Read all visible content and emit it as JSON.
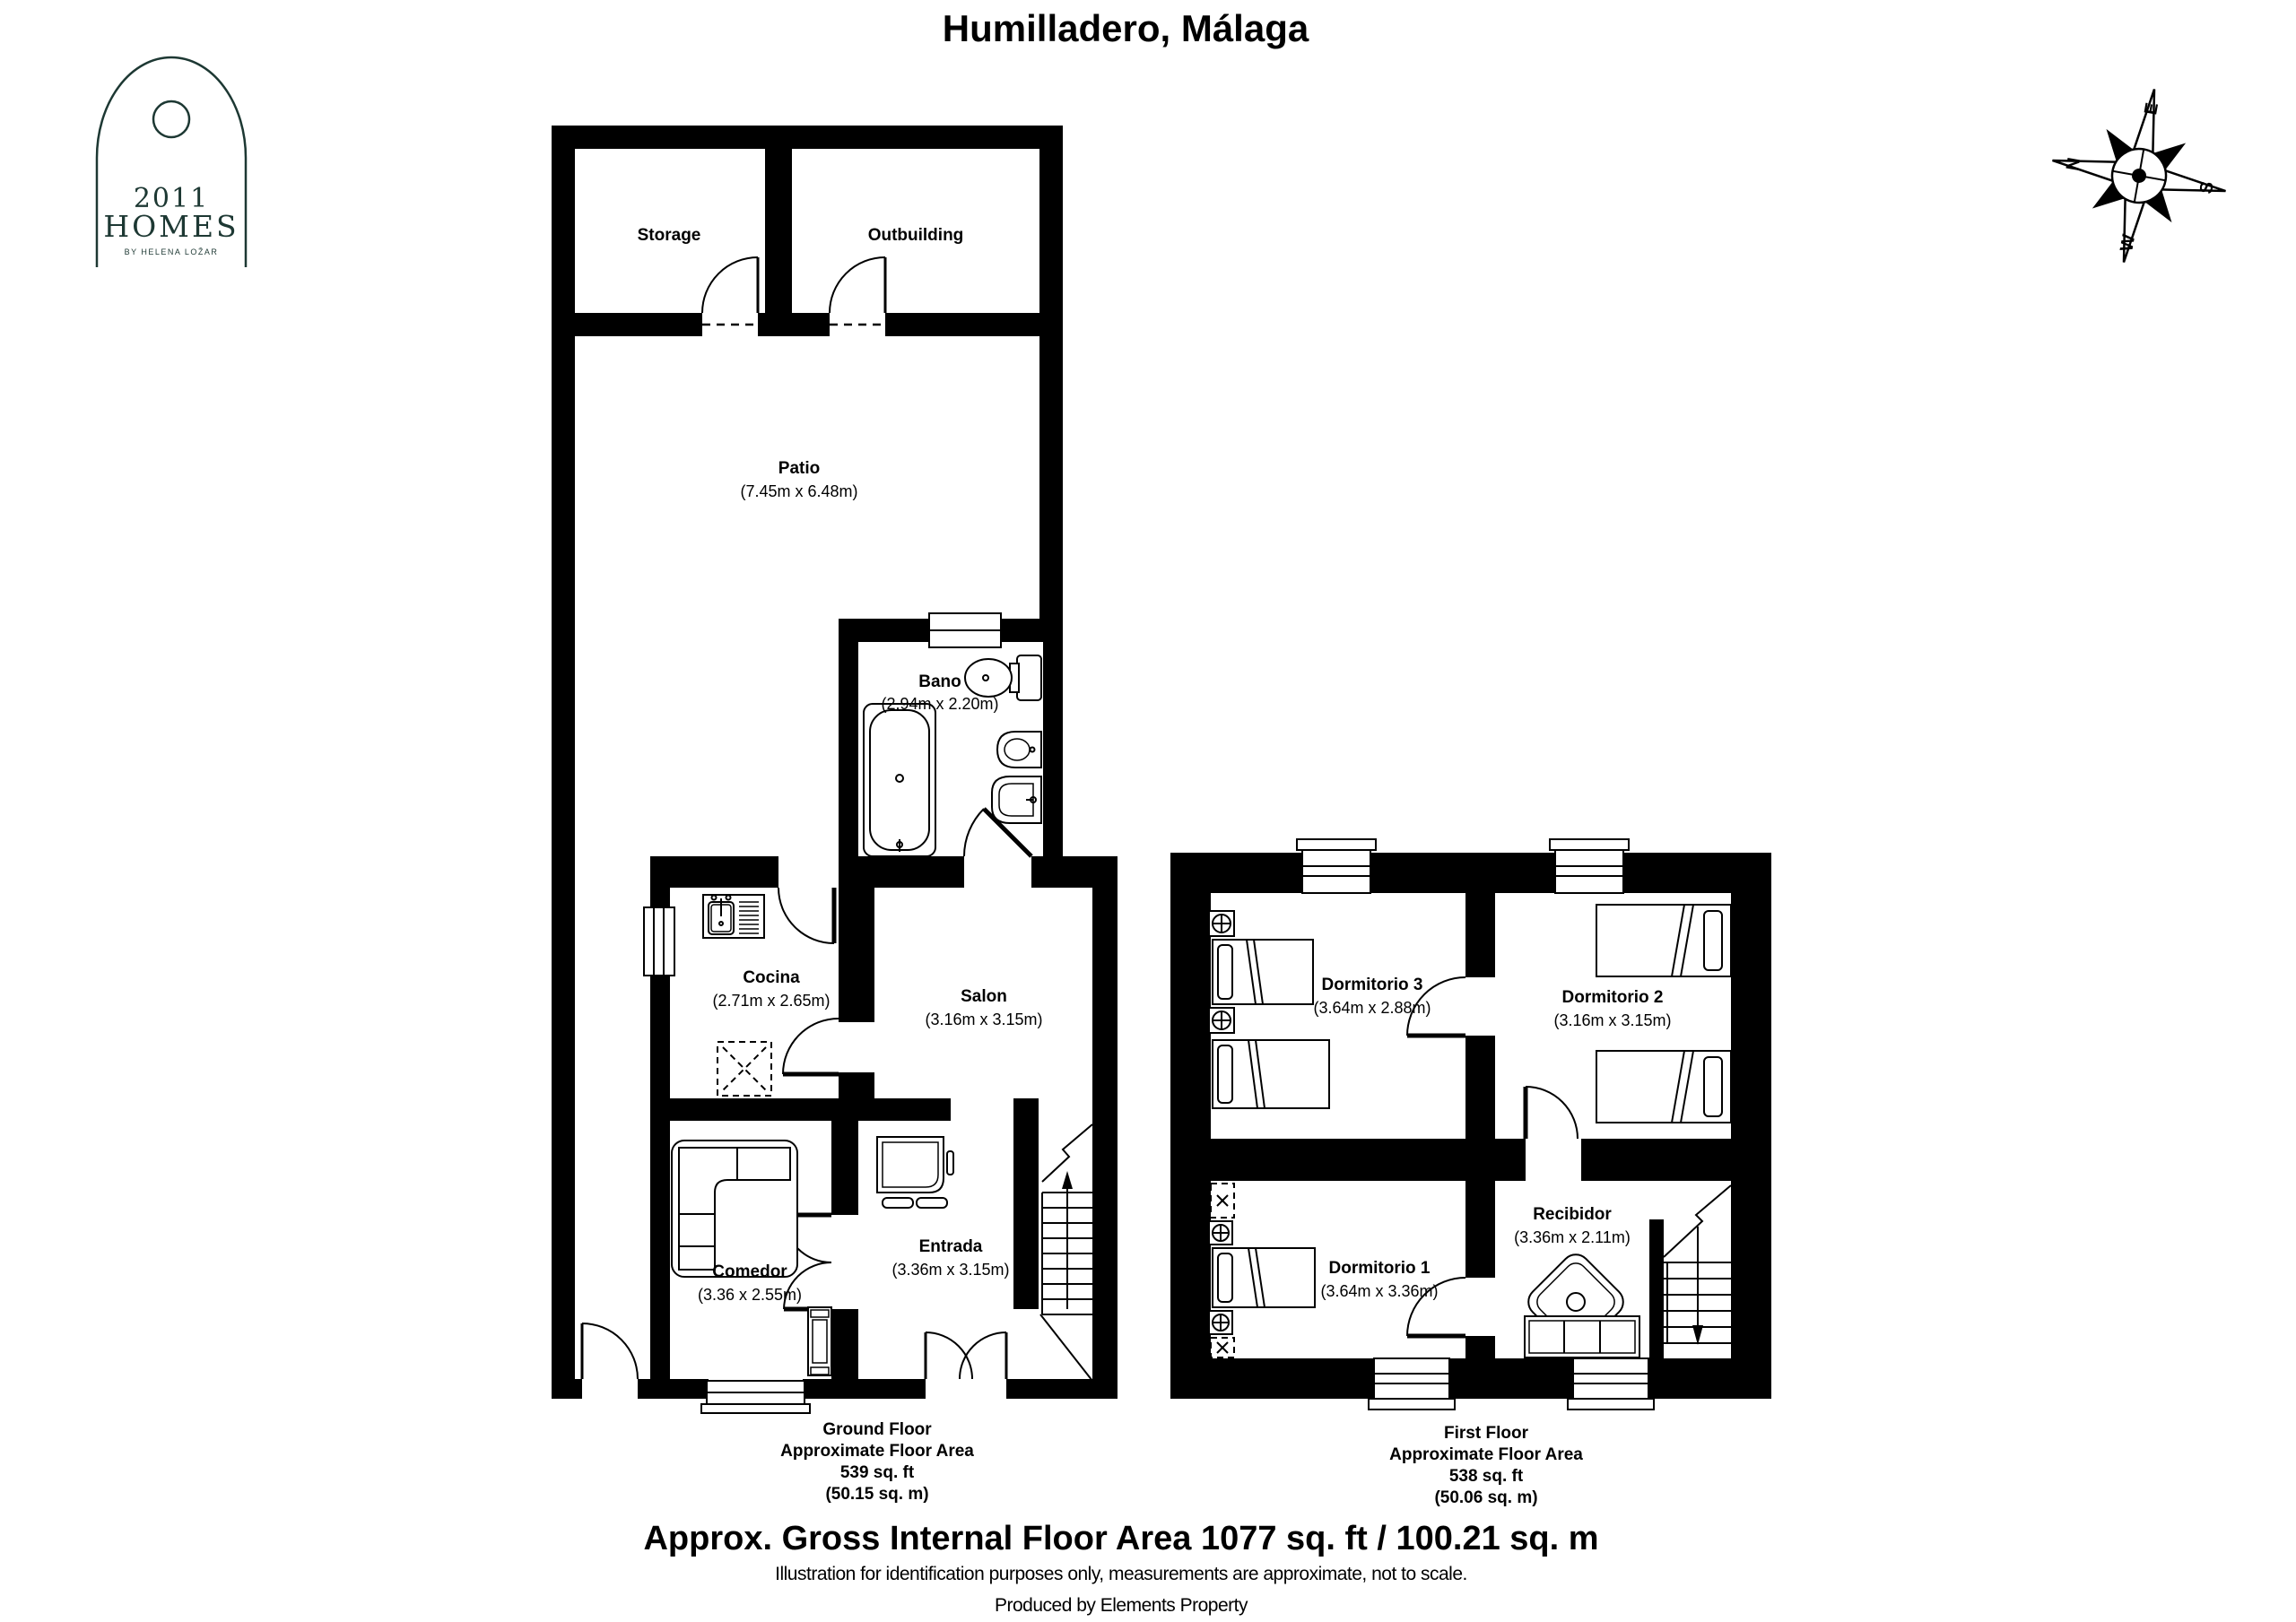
{
  "title": "Humilladero, Málaga",
  "logo": {
    "year": "2011",
    "name": "HOMES",
    "byline": "BY HELENA LOŽAR",
    "color": "#1d3833"
  },
  "compass": {
    "n": "N",
    "e": "E",
    "s": "S",
    "w": "W"
  },
  "colors": {
    "walls": "#000000",
    "background": "#ffffff",
    "logo": "#1d3833"
  },
  "ground_floor": {
    "rooms": [
      {
        "name": "Storage",
        "dims": ""
      },
      {
        "name": "Outbuilding",
        "dims": ""
      },
      {
        "name": "Patio",
        "dims": "(7.45m x 6.48m)"
      },
      {
        "name": "Bano",
        "dims": "(2.94m x 2.20m)"
      },
      {
        "name": "Cocina",
        "dims": "(2.71m x 2.65m)"
      },
      {
        "name": "Salon",
        "dims": "(3.16m x 3.15m)"
      },
      {
        "name": "Comedor",
        "dims": "(3.36 x 2.55m)"
      },
      {
        "name": "Entrada",
        "dims": "(3.36m x 3.15m)"
      }
    ],
    "caption": {
      "line1": "Ground Floor",
      "line2": "Approximate Floor Area",
      "line3": "539 sq. ft",
      "line4": "(50.15 sq. m)"
    }
  },
  "first_floor": {
    "rooms": [
      {
        "name": "Dormitorio 3",
        "dims": "(3.64m x 2.88m)"
      },
      {
        "name": "Dormitorio 2",
        "dims": "(3.16m x 3.15m)"
      },
      {
        "name": "Dormitorio 1",
        "dims": "(3.64m x 3.36m)"
      },
      {
        "name": "Recibidor",
        "dims": "(3.36m x 2.11m)"
      }
    ],
    "caption": {
      "line1": "First Floor",
      "line2": "Approximate Floor Area",
      "line3": "538 sq. ft",
      "line4": "(50.06 sq. m)"
    }
  },
  "footer": {
    "area_line": "Approx. Gross Internal Floor Area 1077 sq. ft / 100.21 sq. m",
    "disclaimer": "Illustration for identification purposes only, measurements are approximate, not to scale.",
    "produced_by": "Produced by Elements Property"
  }
}
